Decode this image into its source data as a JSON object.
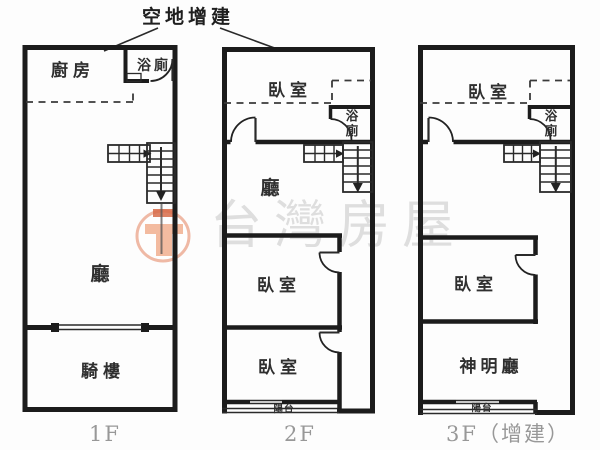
{
  "annotation": {
    "label": "空地增建"
  },
  "watermark": {
    "text": "台灣房屋",
    "logo_icon": "taiwan-housing-logo"
  },
  "floors": [
    {
      "floor_label": "1F",
      "rooms": {
        "kitchen": "廚房",
        "bathroom": "浴廁",
        "living_room": "廳",
        "arcade": "騎樓"
      }
    },
    {
      "floor_label": "2F",
      "rooms": {
        "bedroom_top": "臥室",
        "bathroom_line1": "浴",
        "bathroom_line2": "廁",
        "living_room": "廳",
        "bedroom_middle": "臥室",
        "bedroom_front": "臥室",
        "balcony": "陽台"
      }
    },
    {
      "floor_label": "3F（增建）",
      "rooms": {
        "bedroom_top": "臥室",
        "bathroom_line1": "浴",
        "bathroom_line2": "廁",
        "bedroom_middle": "臥室",
        "shrine_hall": "神明廳",
        "balcony": "陽台"
      }
    }
  ],
  "colors": {
    "wall": "#1c1c1c",
    "floor_label_gray": "#989898",
    "watermark_gray": "#dbdbdb",
    "logo_ring": "#eeb09a",
    "logo_fill": "#f2b294",
    "logo_accent": "#d2572f"
  }
}
